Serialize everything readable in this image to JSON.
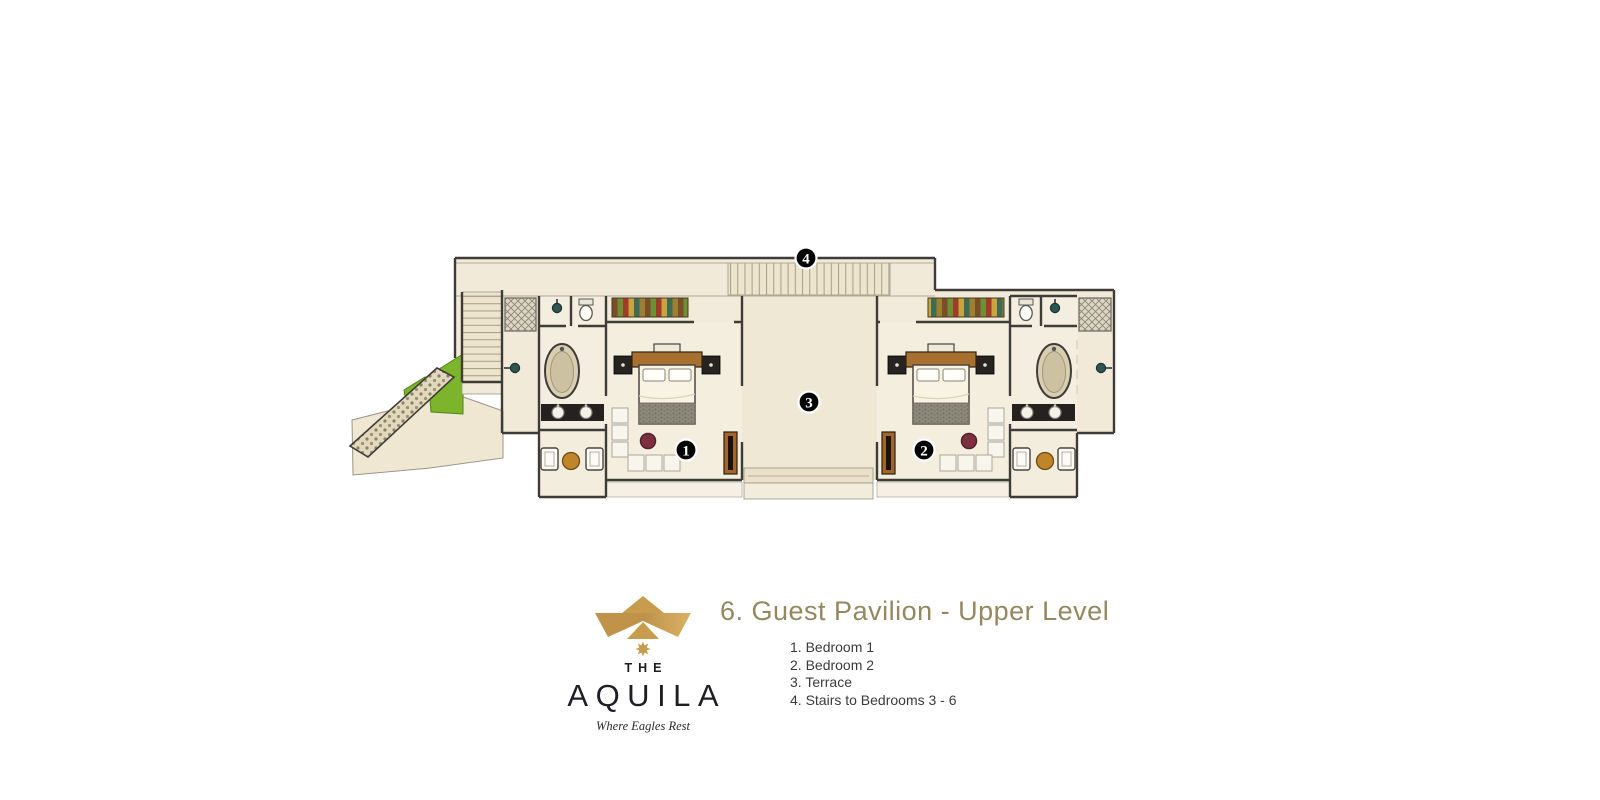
{
  "page": {
    "background_color": "#ffffff"
  },
  "plan": {
    "title": "6. Guest Pavilion - Upper Level",
    "title_color": "#95875e",
    "legend": [
      "1. Bedroom 1",
      "2. Bedroom 2",
      "3. Terrace",
      "4. Stairs to Bedrooms 3 - 6"
    ],
    "badges": {
      "bedroom1": "1",
      "bedroom2": "2",
      "terrace": "3",
      "stairs": "4"
    }
  },
  "logo": {
    "prefix": "THE",
    "name": "AQUILA",
    "tagline": "Where Eagles Rest",
    "gold": "#c79e4f",
    "ink": "#1e1e24"
  },
  "colors": {
    "floor_beige": "#f1ead9",
    "stair_tread": "#ede4ce",
    "wall_dark": "#3f3c37",
    "grass_green": "#7cb52b",
    "wood_brown": "#a8702f",
    "table_gold": "#c08429",
    "pouf_red": "#7e3040",
    "blanket_gray": "#8d897a"
  }
}
